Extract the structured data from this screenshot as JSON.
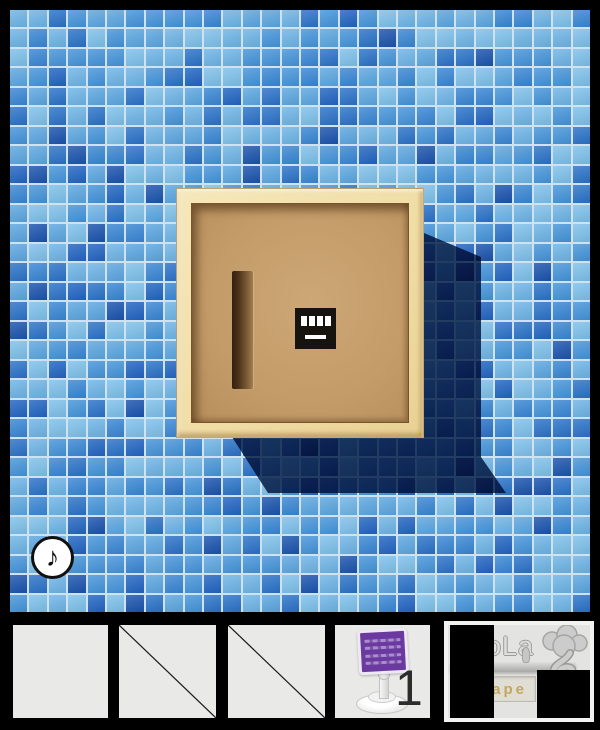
{
  "scene": {
    "wall": {
      "cols": 30,
      "rows": 31,
      "seed": 1337,
      "grout_color": "#cfe2f0",
      "tile_palette": [
        {
          "color": "#7dc0ea",
          "weight": 3
        },
        {
          "color": "#6db4e6",
          "weight": 3
        },
        {
          "color": "#5ba6e0",
          "weight": 2
        },
        {
          "color": "#4494da",
          "weight": 3
        },
        {
          "color": "#3886d4",
          "weight": 2
        },
        {
          "color": "#2a72c8",
          "weight": 2
        },
        {
          "color": "#2164c2",
          "weight": 1
        },
        {
          "color": "#1a53ae",
          "weight": 1
        }
      ]
    },
    "shadow_color": "#2b4468",
    "box": {
      "frame_color": "#f0dda6",
      "panel_color": "#c39b68",
      "keypad": {
        "cells": 4,
        "cell_color": "#ffffff",
        "bg_color": "#17130e"
      }
    },
    "music_button": {
      "glyph": "♪"
    }
  },
  "inventory": {
    "slots": [
      {
        "state": "empty"
      },
      {
        "state": "crossed"
      },
      {
        "state": "crossed"
      },
      {
        "state": "item",
        "item": "sign-on-stand",
        "count": "1",
        "sign_color": "#6b3aa0"
      }
    ],
    "logo": {
      "title": "oLa",
      "plaque_text": "ape",
      "title_color": "#dedede",
      "plaque_text_color": "#c2a75e"
    }
  }
}
